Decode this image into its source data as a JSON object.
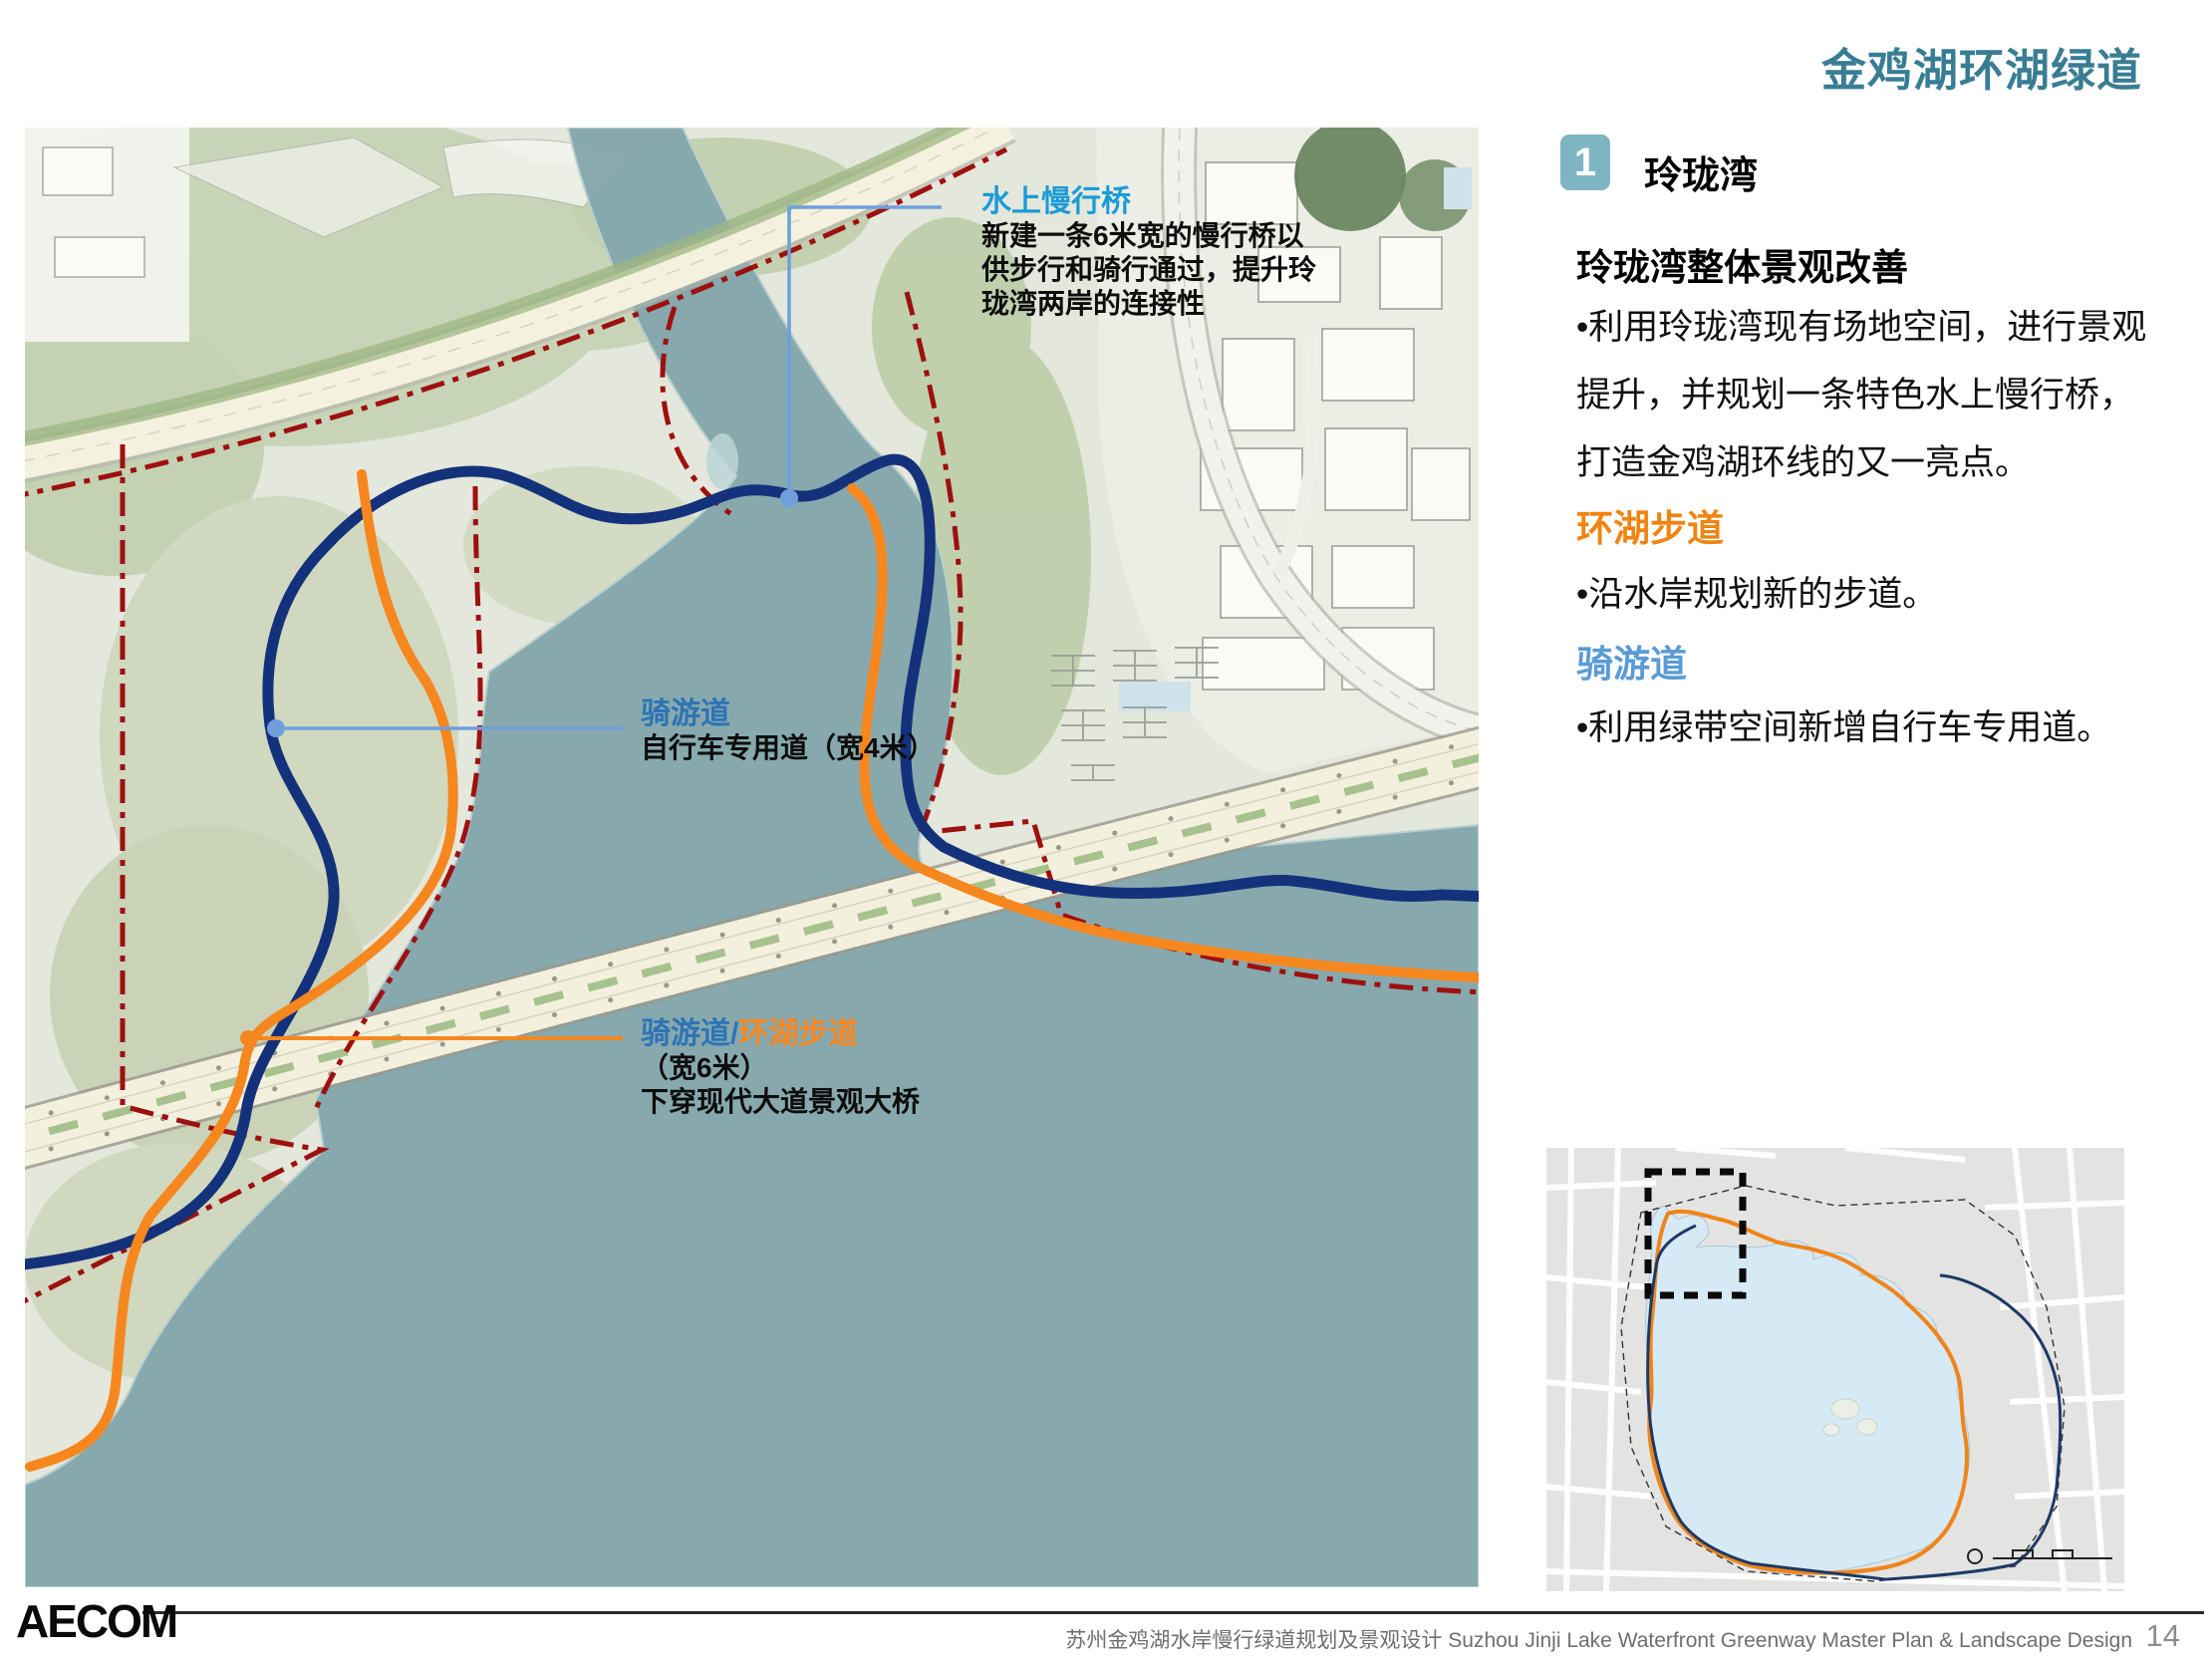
{
  "page": {
    "title": "金鸡湖环湖绿道",
    "brand": "AECOM",
    "footer": "苏州金鸡湖水岸慢行绿道规划及景观设计 Suzhou Jinji Lake Waterfront Greenway  Master Plan & Landscape Design",
    "page_number": "14"
  },
  "panel": {
    "badge": "1",
    "heading": "玲珑湾",
    "subheading": "玲珑湾整体景观改善",
    "para_lines": [
      "•利用玲珑湾现有场地空间，进行景观",
      "提升，并规划一条特色水上慢行桥，",
      "打造金鸡湖环线的又一亮点。"
    ],
    "orange_heading": "环湖步道",
    "orange_bullet": "•沿水岸规划新的步道。",
    "blue_heading": "骑游道",
    "blue_bullet": "•利用绿带空间新增自行车专用道。"
  },
  "annotations": {
    "water_bridge": {
      "title": "水上慢行桥",
      "line1": "新建一条6米宽的慢行桥以",
      "line2": "供步行和骑行通过，提升玲",
      "line3": "珑湾两岸的连接性"
    },
    "bike_path": {
      "title": "骑游道",
      "desc": "自行车专用道（宽4米）"
    },
    "combined_path": {
      "title_blue": "骑游道",
      "slash": "/",
      "title_orange": "环湖步道",
      "line1": "（宽6米）",
      "line2": "下穿现代大道景观大桥"
    }
  },
  "legend_colors": {
    "title_teal": "#397D94",
    "badge_teal": "#7FB5C3",
    "route_navy": "#14327B",
    "route_orange": "#F6871F",
    "boundary_red": "#9E1010",
    "callout_blue": "#6FA0DC",
    "water_teal": "#85A8AD",
    "heading_orange": "#F08410",
    "heading_blue": "#5B9BD5"
  }
}
